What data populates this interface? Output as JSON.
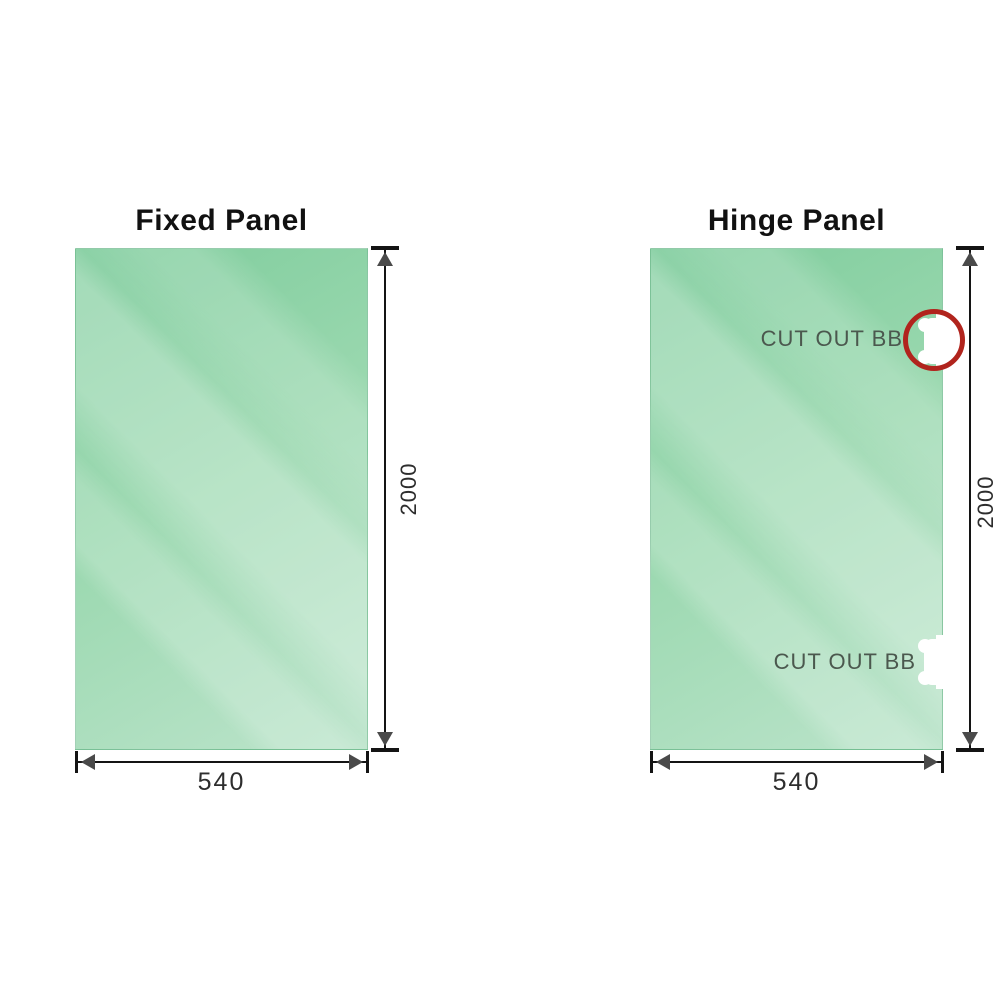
{
  "diagram": {
    "title_left": "Fixed Panel",
    "title_right": "Hinge Panel",
    "panels": [
      {
        "title": "Fixed Panel",
        "width_dim": "540",
        "height_dim": "2000",
        "cutouts": []
      },
      {
        "title": "Hinge Panel",
        "width_dim": "540",
        "height_dim": "2000",
        "cutouts": [
          {
            "label": "CUT OUT BB",
            "position": "top-right",
            "highlighted": true
          },
          {
            "label": "CUT OUT BB",
            "position": "bottom-right",
            "highlighted": false
          }
        ]
      }
    ]
  },
  "colors": {
    "glass_dark": "#7ecc9c",
    "glass_mid": "#9ad8af",
    "glass_light": "#bce4cb",
    "line": "#141414",
    "arrow": "#4a4a4a",
    "dim_text": "#2d2d2d",
    "cutout_label": "#4b584e",
    "ring": "#b1241d",
    "bg": "#ffffff"
  }
}
